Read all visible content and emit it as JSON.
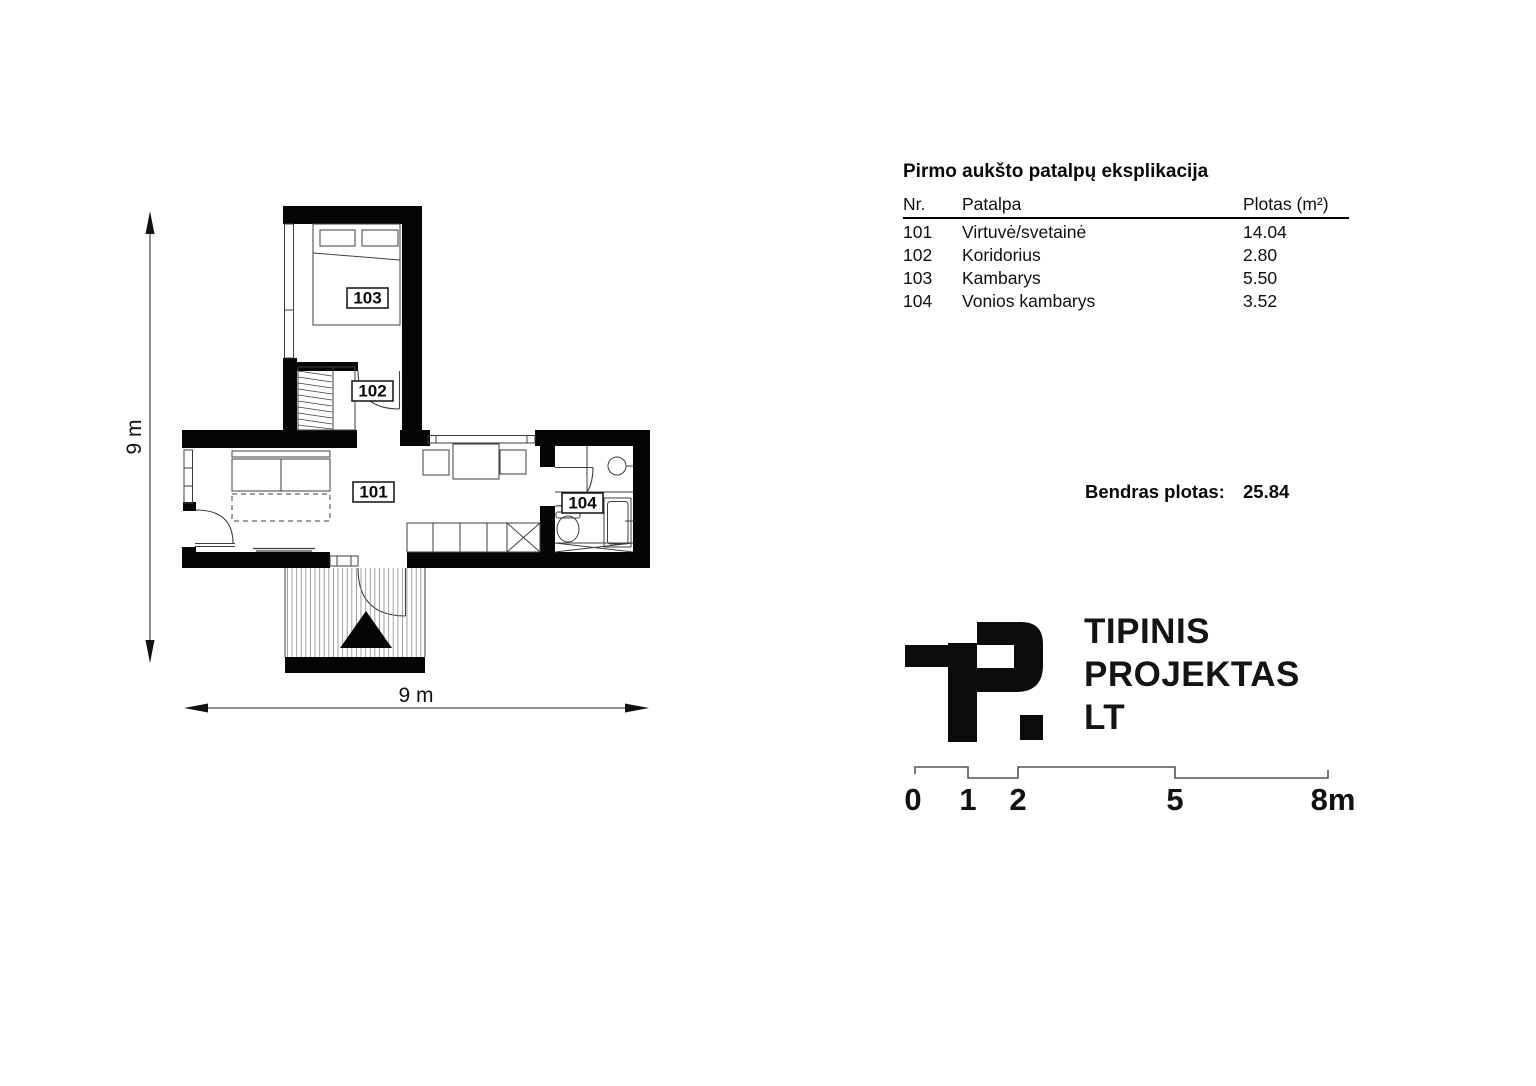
{
  "explication": {
    "title": "Pirmo aukšto patalpų eksplikacija",
    "headers": {
      "nr": "Nr.",
      "room": "Patalpa",
      "area": "Plotas (m²)"
    },
    "rows": [
      {
        "nr": "101",
        "room": "Virtuvė/svetainė",
        "area": "14.04"
      },
      {
        "nr": "102",
        "room": "Koridorius",
        "area": "2.80"
      },
      {
        "nr": "103",
        "room": "Kambarys",
        "area": "5.50"
      },
      {
        "nr": "104",
        "room": "Vonios kambarys",
        "area": "3.52"
      }
    ]
  },
  "total": {
    "label": "Bendras plotas:",
    "value": "25.84"
  },
  "logo": {
    "line1": "TIPINIS",
    "line2": "PROJEKTAS",
    "line3": "LT"
  },
  "scalebar": {
    "labels": [
      "0",
      "1",
      "2",
      "5",
      "8m"
    ]
  },
  "plan": {
    "room_labels": {
      "r101": "101",
      "r102": "102",
      "r103": "103",
      "r104": "104"
    },
    "dims": {
      "width": "9 m",
      "height": "9 m"
    }
  },
  "colors": {
    "ink": "#000000",
    "drawing_line": "#3f3f3f",
    "hatch": "#8a8a8a"
  }
}
